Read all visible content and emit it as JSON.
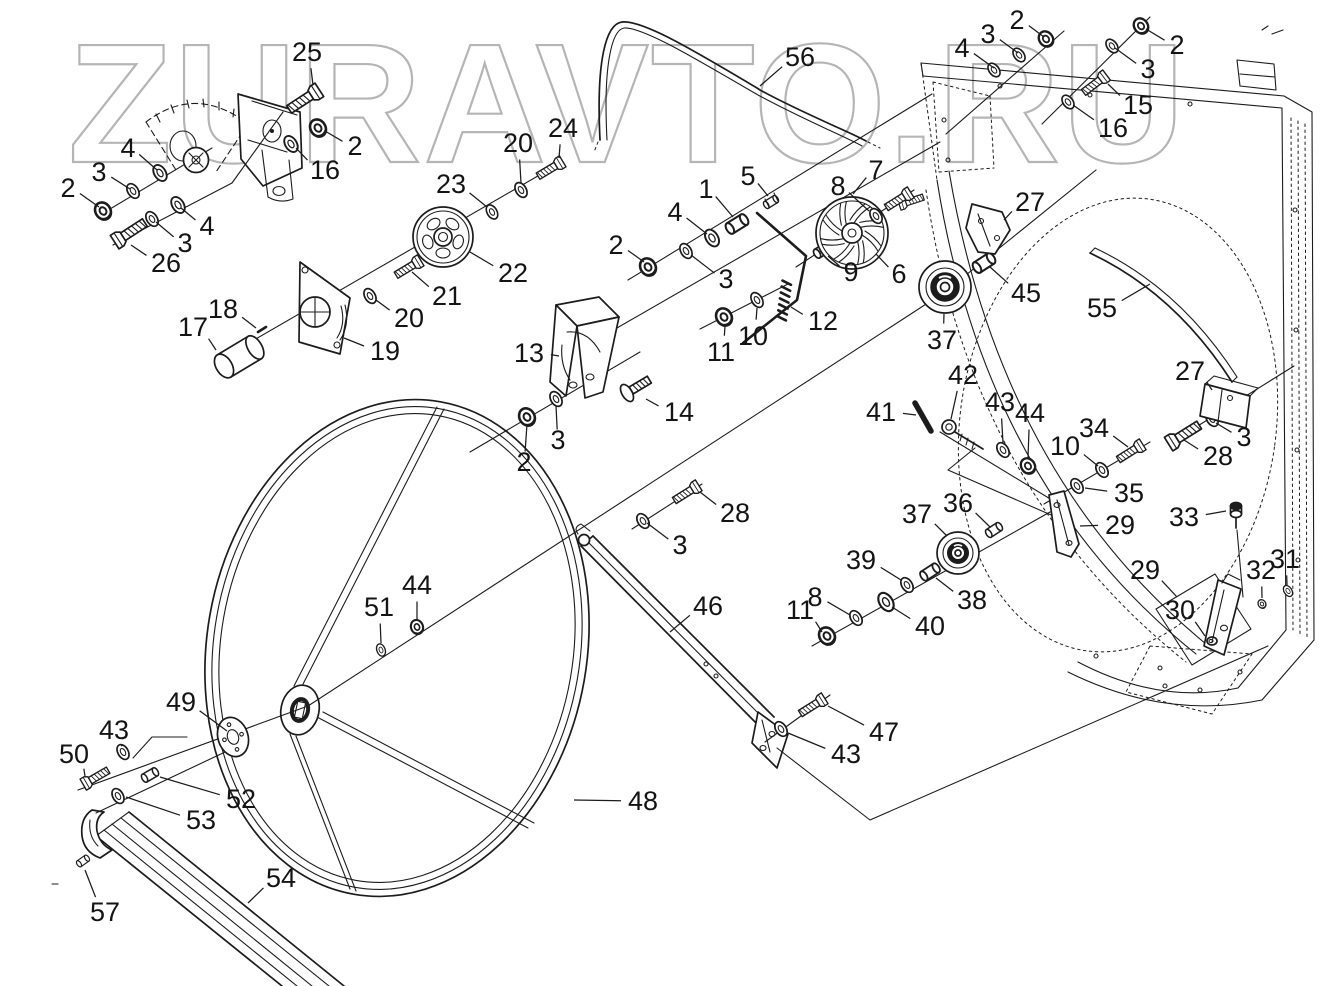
{
  "watermark": {
    "text": "ZURAVTO.RU",
    "color": "#b5b5b5"
  },
  "colors": {
    "background": "#ffffff",
    "line": "#1c1c1c",
    "watermark": "#b5b5b5"
  },
  "diagram": {
    "type": "exploded-parts-diagram",
    "callouts": [
      {
        "label": "25",
        "x": 307,
        "y": 52,
        "tx": 313,
        "ty": 85
      },
      {
        "label": "2",
        "x": 355,
        "y": 146,
        "tx": 325,
        "ty": 131
      },
      {
        "label": "16",
        "x": 325,
        "y": 170,
        "tx": 296,
        "ty": 148
      },
      {
        "label": "4",
        "x": 128,
        "y": 148,
        "tx": 157,
        "ty": 170
      },
      {
        "label": "3",
        "x": 99,
        "y": 172,
        "tx": 130,
        "ty": 189
      },
      {
        "label": "2",
        "x": 68,
        "y": 188,
        "tx": 99,
        "ty": 207
      },
      {
        "label": "4",
        "x": 207,
        "y": 226,
        "tx": 181,
        "ty": 208
      },
      {
        "label": "3",
        "x": 185,
        "y": 243,
        "tx": 156,
        "ty": 222
      },
      {
        "label": "26",
        "x": 166,
        "y": 263,
        "tx": 131,
        "ty": 245
      },
      {
        "label": "17",
        "x": 193,
        "y": 327,
        "tx": 216,
        "ty": 350
      },
      {
        "label": "18",
        "x": 223,
        "y": 309,
        "tx": 256,
        "ty": 328
      },
      {
        "label": "19",
        "x": 385,
        "y": 351,
        "tx": 344,
        "ty": 338
      },
      {
        "label": "20",
        "x": 409,
        "y": 318,
        "tx": 376,
        "ty": 300
      },
      {
        "label": "21",
        "x": 447,
        "y": 296,
        "tx": 412,
        "ty": 272
      },
      {
        "label": "22",
        "x": 513,
        "y": 273,
        "tx": 470,
        "ty": 252
      },
      {
        "label": "23",
        "x": 451,
        "y": 184,
        "tx": 487,
        "ty": 207
      },
      {
        "label": "20",
        "x": 518,
        "y": 143,
        "tx": 521,
        "ty": 183
      },
      {
        "label": "24",
        "x": 563,
        "y": 128,
        "tx": 559,
        "ty": 158
      },
      {
        "label": "56",
        "x": 800,
        "y": 57,
        "tx": 760,
        "ty": 86
      },
      {
        "label": "2",
        "x": 1017,
        "y": 20,
        "tx": 1044,
        "ty": 37
      },
      {
        "label": "3",
        "x": 988,
        "y": 34,
        "tx": 1018,
        "ty": 53
      },
      {
        "label": "4",
        "x": 962,
        "y": 48,
        "tx": 994,
        "ty": 68
      },
      {
        "label": "2",
        "x": 1177,
        "y": 45,
        "tx": 1146,
        "ty": 29
      },
      {
        "label": "3",
        "x": 1148,
        "y": 69,
        "tx": 1115,
        "ty": 48
      },
      {
        "label": "15",
        "x": 1138,
        "y": 105,
        "tx": 1108,
        "ty": 84
      },
      {
        "label": "16",
        "x": 1113,
        "y": 128,
        "tx": 1073,
        "ty": 105
      },
      {
        "label": "1",
        "x": 706,
        "y": 189,
        "tx": 733,
        "ty": 217
      },
      {
        "label": "5",
        "x": 748,
        "y": 176,
        "tx": 768,
        "ty": 196
      },
      {
        "label": "7",
        "x": 876,
        "y": 170,
        "tx": 853,
        "ty": 194
      },
      {
        "label": "8",
        "x": 838,
        "y": 186,
        "tx": 869,
        "ty": 211
      },
      {
        "label": "4",
        "x": 675,
        "y": 212,
        "tx": 707,
        "ty": 234
      },
      {
        "label": "2",
        "x": 616,
        "y": 245,
        "tx": 644,
        "ty": 262
      },
      {
        "label": "3",
        "x": 726,
        "y": 279,
        "tx": 691,
        "ty": 255
      },
      {
        "label": "9",
        "x": 851,
        "y": 272,
        "tx": 828,
        "ty": 256
      },
      {
        "label": "6",
        "x": 899,
        "y": 274,
        "tx": 876,
        "ty": 254
      },
      {
        "label": "12",
        "x": 823,
        "y": 321,
        "tx": 791,
        "ty": 307
      },
      {
        "label": "10",
        "x": 753,
        "y": 336,
        "tx": 757,
        "ty": 308
      },
      {
        "label": "11",
        "x": 721,
        "y": 352,
        "tx": 725,
        "ty": 326
      },
      {
        "label": "13",
        "x": 529,
        "y": 353,
        "tx": 559,
        "ty": 356
      },
      {
        "label": "14",
        "x": 679,
        "y": 412,
        "tx": 646,
        "ty": 399
      },
      {
        "label": "3",
        "x": 558,
        "y": 440,
        "tx": 556,
        "ty": 406
      },
      {
        "label": "2",
        "x": 524,
        "y": 462,
        "tx": 527,
        "ty": 424
      },
      {
        "label": "27",
        "x": 1030,
        "y": 202,
        "tx": 1004,
        "ty": 220
      },
      {
        "label": "45",
        "x": 1026,
        "y": 293,
        "tx": 990,
        "ty": 267
      },
      {
        "label": "37",
        "x": 942,
        "y": 340,
        "tx": 944,
        "ty": 314
      },
      {
        "label": "55",
        "x": 1102,
        "y": 308,
        "tx": 1150,
        "ty": 284
      },
      {
        "label": "27",
        "x": 1190,
        "y": 371,
        "tx": 1212,
        "ty": 390
      },
      {
        "label": "3",
        "x": 1244,
        "y": 437,
        "tx": 1216,
        "ty": 423
      },
      {
        "label": "28",
        "x": 1218,
        "y": 456,
        "tx": 1184,
        "ty": 440
      },
      {
        "label": "41",
        "x": 881,
        "y": 412,
        "tx": 916,
        "ty": 415
      },
      {
        "label": "42",
        "x": 963,
        "y": 375,
        "tx": 951,
        "ty": 419
      },
      {
        "label": "43",
        "x": 1000,
        "y": 402,
        "tx": 1003,
        "ty": 443
      },
      {
        "label": "44",
        "x": 1030,
        "y": 413,
        "tx": 1028,
        "ty": 458
      },
      {
        "label": "34",
        "x": 1094,
        "y": 428,
        "tx": 1128,
        "ty": 447
      },
      {
        "label": "10",
        "x": 1065,
        "y": 446,
        "tx": 1098,
        "ty": 466
      },
      {
        "label": "35",
        "x": 1129,
        "y": 493,
        "tx": 1085,
        "ty": 488
      },
      {
        "label": "36",
        "x": 958,
        "y": 503,
        "tx": 990,
        "ty": 527
      },
      {
        "label": "29",
        "x": 1120,
        "y": 525,
        "tx": 1080,
        "ty": 526
      },
      {
        "label": "33",
        "x": 1184,
        "y": 517,
        "tx": 1226,
        "ty": 511
      },
      {
        "label": "37",
        "x": 917,
        "y": 514,
        "tx": 947,
        "ty": 536
      },
      {
        "label": "39",
        "x": 861,
        "y": 560,
        "tx": 901,
        "ty": 580
      },
      {
        "label": "38",
        "x": 972,
        "y": 600,
        "tx": 936,
        "ty": 578
      },
      {
        "label": "40",
        "x": 930,
        "y": 626,
        "tx": 892,
        "ty": 607
      },
      {
        "label": "8",
        "x": 815,
        "y": 597,
        "tx": 850,
        "ty": 615
      },
      {
        "label": "11",
        "x": 800,
        "y": 610,
        "tx": 822,
        "ty": 632
      },
      {
        "label": "29",
        "x": 1145,
        "y": 570,
        "tx": 1177,
        "ty": 597
      },
      {
        "label": "30",
        "x": 1180,
        "y": 610,
        "tx": 1205,
        "ty": 636
      },
      {
        "label": "32",
        "x": 1261,
        "y": 570,
        "tx": 1262,
        "ty": 598
      },
      {
        "label": "31",
        "x": 1285,
        "y": 559,
        "tx": 1287,
        "ty": 585
      },
      {
        "label": "28",
        "x": 735,
        "y": 513,
        "tx": 700,
        "ty": 492
      },
      {
        "label": "3",
        "x": 680,
        "y": 545,
        "tx": 647,
        "ty": 523
      },
      {
        "label": "46",
        "x": 708,
        "y": 606,
        "tx": 670,
        "ty": 632
      },
      {
        "label": "44",
        "x": 417,
        "y": 585,
        "tx": 417,
        "ty": 619
      },
      {
        "label": "51",
        "x": 379,
        "y": 607,
        "tx": 381,
        "ty": 643
      },
      {
        "label": "49",
        "x": 181,
        "y": 702,
        "tx": 227,
        "ty": 731
      },
      {
        "label": "43",
        "x": 114,
        "y": 730,
        "tx": 121,
        "ty": 746
      },
      {
        "label": "50",
        "x": 74,
        "y": 754,
        "tx": 85,
        "ty": 776
      },
      {
        "label": "52",
        "x": 241,
        "y": 799,
        "tx": 160,
        "ty": 777
      },
      {
        "label": "53",
        "x": 201,
        "y": 820,
        "tx": 126,
        "ty": 797
      },
      {
        "label": "48",
        "x": 643,
        "y": 801,
        "tx": 574,
        "ty": 800
      },
      {
        "label": "54",
        "x": 281,
        "y": 878,
        "tx": 248,
        "ty": 903
      },
      {
        "label": "57",
        "x": 105,
        "y": 912,
        "tx": 85,
        "ty": 870
      },
      {
        "label": "47",
        "x": 884,
        "y": 732,
        "tx": 828,
        "ty": 706
      },
      {
        "label": "43",
        "x": 846,
        "y": 754,
        "tx": 788,
        "ty": 733
      }
    ]
  }
}
